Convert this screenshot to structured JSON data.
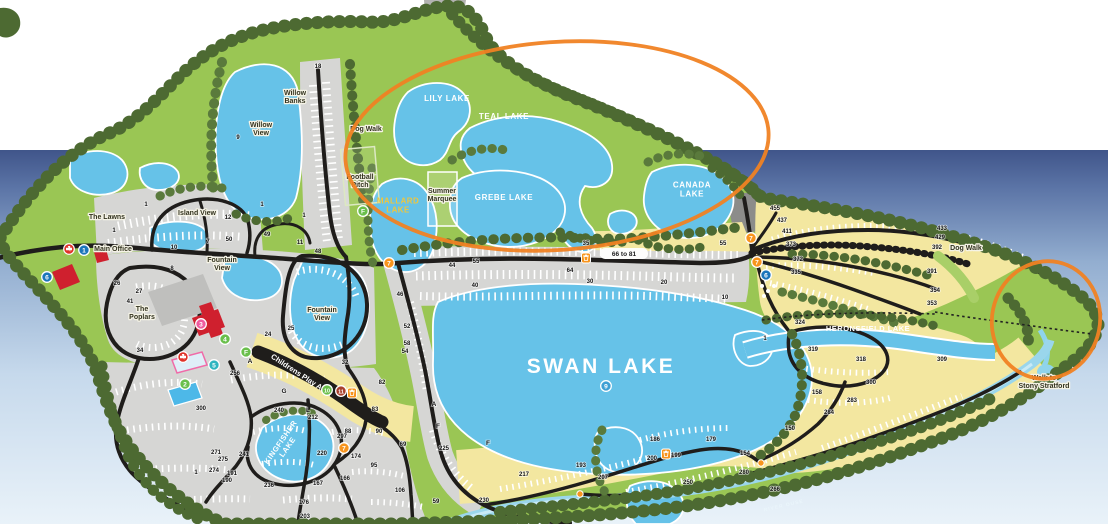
{
  "annotations": {
    "color": "#f08223",
    "ellipses": [
      {
        "cx": 557,
        "cy": 146,
        "rx": 212,
        "ry": 104,
        "rotate": -4
      },
      {
        "cx": 1046,
        "cy": 320,
        "rx": 54,
        "ry": 59,
        "rotate": 12
      }
    ]
  },
  "map": {
    "labels": [
      {
        "text": "LILY LAKE",
        "x": 447,
        "y": 101,
        "kind": "lake"
      },
      {
        "text": "TEAL LAKE",
        "x": 504,
        "y": 119,
        "kind": "lake"
      },
      {
        "text": "GREBE LAKE",
        "x": 504,
        "y": 200,
        "kind": "lake"
      },
      {
        "text": "CANADA\nLAKE",
        "x": 692,
        "y": 192,
        "kind": "lake"
      },
      {
        "text": "MALLARD\nLAKE",
        "x": 398,
        "y": 208,
        "kind": "lake_yellow"
      },
      {
        "text": "SWAN LAKE",
        "x": 601,
        "y": 373,
        "kind": "lake_big"
      },
      {
        "text": "HERONSFIELD LAKE",
        "x": 868,
        "y": 331,
        "kind": "lake_small"
      },
      {
        "text": "KINGFISHER\nLAKE",
        "x": 286,
        "y": 446,
        "kind": "lake_small",
        "rotate": -55
      },
      {
        "text": "Willow\nBanks",
        "x": 295,
        "y": 99,
        "kind": "place"
      },
      {
        "text": "Willow\nView",
        "x": 261,
        "y": 131,
        "kind": "place"
      },
      {
        "text": "Island View",
        "x": 197,
        "y": 215,
        "kind": "place"
      },
      {
        "text": "The Lawns",
        "x": 107,
        "y": 219,
        "kind": "place"
      },
      {
        "text": "Main Office",
        "x": 113,
        "y": 251,
        "kind": "place"
      },
      {
        "text": "Fountain\nView",
        "x": 222,
        "y": 266,
        "kind": "place"
      },
      {
        "text": "Fountain\nView",
        "x": 322,
        "y": 316,
        "kind": "place"
      },
      {
        "text": "The\nPoplars",
        "x": 142,
        "y": 315,
        "kind": "place"
      },
      {
        "text": "Dog Walk",
        "x": 366,
        "y": 131,
        "kind": "place"
      },
      {
        "text": "Dog Walk",
        "x": 966,
        "y": 250,
        "kind": "place"
      },
      {
        "text": "Football\nPitch",
        "x": 360,
        "y": 183,
        "kind": "place"
      },
      {
        "text": "Summer\nMarquee",
        "x": 442,
        "y": 197,
        "kind": "place"
      },
      {
        "text": "Childrens Play Area",
        "x": 300,
        "y": 377,
        "kind": "play",
        "rotate": 33
      },
      {
        "text": "Walk to\nStony Stratford",
        "x": 1044,
        "y": 384,
        "kind": "place"
      },
      {
        "text": "66 to 81",
        "x": 624,
        "y": 256,
        "kind": "road"
      },
      {
        "text": "RIVER OUSE",
        "x": 784,
        "y": 507,
        "kind": "river",
        "rotate": -13
      }
    ],
    "site_numbers": [
      [
        "18",
        318,
        68
      ],
      [
        "9",
        238,
        139
      ],
      [
        "1",
        146,
        206
      ],
      [
        "1",
        262,
        206
      ],
      [
        "12",
        228,
        219
      ],
      [
        "1",
        304,
        217
      ],
      [
        "1",
        114,
        232
      ],
      [
        "49",
        267,
        236
      ],
      [
        "50",
        229,
        241
      ],
      [
        "7",
        208,
        243
      ],
      [
        "10",
        174,
        249
      ],
      [
        "8",
        172,
        270
      ],
      [
        "11",
        300,
        244
      ],
      [
        "48",
        318,
        253
      ],
      [
        "26",
        117,
        285
      ],
      [
        "27",
        139,
        293
      ],
      [
        "41",
        130,
        303
      ],
      [
        "25",
        291,
        330
      ],
      [
        "24",
        268,
        336
      ],
      [
        "34",
        140,
        352
      ],
      [
        "32",
        345,
        364
      ],
      [
        "256",
        235,
        375
      ],
      [
        "300",
        201,
        410
      ],
      [
        "240",
        279,
        412
      ],
      [
        "212",
        313,
        419
      ],
      [
        "82",
        382,
        384
      ],
      [
        "83",
        375,
        411
      ],
      [
        "88",
        348,
        433
      ],
      [
        "297",
        342,
        438
      ],
      [
        "90",
        379,
        433
      ],
      [
        "69",
        403,
        446
      ],
      [
        "220",
        322,
        455
      ],
      [
        "174",
        356,
        458
      ],
      [
        "95",
        374,
        467
      ],
      [
        "241",
        244,
        456
      ],
      [
        "271",
        216,
        454
      ],
      [
        "275",
        223,
        461
      ],
      [
        "274",
        214,
        472
      ],
      [
        "191",
        232,
        475
      ],
      [
        "190",
        227,
        482
      ],
      [
        "1",
        196,
        474
      ],
      [
        "236",
        269,
        487
      ],
      [
        "167",
        318,
        485
      ],
      [
        "166",
        345,
        480
      ],
      [
        "176",
        304,
        504
      ],
      [
        "203",
        305,
        518
      ],
      [
        "106",
        400,
        492
      ],
      [
        "59",
        436,
        503
      ],
      [
        "225",
        444,
        450
      ],
      [
        "230",
        484,
        502
      ],
      [
        "217",
        524,
        476
      ],
      [
        "193",
        581,
        467
      ],
      [
        "207",
        603,
        479
      ],
      [
        "186",
        655,
        441
      ],
      [
        "179",
        711,
        441
      ],
      [
        "200",
        652,
        460
      ],
      [
        "199",
        676,
        457
      ],
      [
        "154",
        745,
        455
      ],
      [
        "280",
        744,
        474
      ],
      [
        "250",
        688,
        484
      ],
      [
        "266",
        775,
        491
      ],
      [
        "150",
        790,
        430
      ],
      [
        "158",
        817,
        394
      ],
      [
        "284",
        829,
        414
      ],
      [
        "283",
        852,
        402
      ],
      [
        "300",
        871,
        384
      ],
      [
        "318",
        861,
        361
      ],
      [
        "319",
        813,
        351
      ],
      [
        "324",
        800,
        324
      ],
      [
        "309",
        942,
        361
      ],
      [
        "353",
        932,
        305
      ],
      [
        "354",
        935,
        292
      ],
      [
        "391",
        932,
        273
      ],
      [
        "392",
        937,
        249
      ],
      [
        "429",
        940,
        239
      ],
      [
        "433",
        942,
        230
      ],
      [
        "335",
        796,
        274
      ],
      [
        "372",
        798,
        261
      ],
      [
        "373",
        791,
        246
      ],
      [
        "411",
        787,
        233
      ],
      [
        "437",
        782,
        222
      ],
      [
        "455",
        775,
        210
      ],
      [
        "35",
        586,
        245
      ],
      [
        "55",
        723,
        245
      ],
      [
        "44",
        452,
        267
      ],
      [
        "55",
        476,
        263
      ],
      [
        "64",
        570,
        272
      ],
      [
        "40",
        475,
        287
      ],
      [
        "30",
        590,
        283
      ],
      [
        "20",
        664,
        284
      ],
      [
        "10",
        725,
        299
      ],
      [
        "1",
        765,
        340
      ],
      [
        "46",
        400,
        296
      ],
      [
        "52",
        407,
        328
      ],
      [
        "58",
        407,
        345
      ],
      [
        "54",
        405,
        353
      ]
    ],
    "letters": [
      [
        "A",
        250,
        363
      ],
      [
        "G",
        284,
        393
      ],
      [
        "L",
        308,
        412
      ],
      [
        "A",
        434,
        406
      ],
      [
        "F",
        438,
        428
      ],
      [
        "F",
        488,
        445
      ]
    ],
    "markers": [
      {
        "kind": "cross",
        "x": 69,
        "y": 249
      },
      {
        "kind": "circle",
        "label": "1",
        "color": "#1b75bb",
        "x": 84,
        "y": 250
      },
      {
        "kind": "circle",
        "label": "6",
        "color": "#1b75bb",
        "x": 47,
        "y": 277
      },
      {
        "kind": "circle",
        "label": "3",
        "color": "#ef5b9f",
        "x": 201,
        "y": 324
      },
      {
        "kind": "circle",
        "label": "4",
        "color": "#6abf4b",
        "x": 225,
        "y": 339
      },
      {
        "kind": "circle",
        "label": "F",
        "color": "#6abf4b",
        "x": 246,
        "y": 352
      },
      {
        "kind": "circle",
        "label": "5",
        "color": "#2eb5c0",
        "x": 214,
        "y": 365
      },
      {
        "kind": "cross",
        "x": 183,
        "y": 357
      },
      {
        "kind": "circle",
        "label": "2",
        "color": "#6abf4b",
        "x": 185,
        "y": 384
      },
      {
        "kind": "circle",
        "label": "10",
        "color": "#6abf4b",
        "x": 327,
        "y": 390
      },
      {
        "kind": "circle",
        "label": "11",
        "color": "#a8402c",
        "x": 341,
        "y": 391
      },
      {
        "kind": "bin",
        "label": "7",
        "color": "#f7941d",
        "x": 352,
        "y": 393
      },
      {
        "kind": "circle",
        "label": "7",
        "color": "#f7941d",
        "x": 344,
        "y": 448
      },
      {
        "kind": "circle",
        "label": "F",
        "color": "#6abf4b",
        "x": 363,
        "y": 211
      },
      {
        "kind": "circle",
        "label": "7",
        "color": "#f7941d",
        "x": 389,
        "y": 263
      },
      {
        "kind": "bin",
        "label": "7",
        "color": "#f7941d",
        "x": 586,
        "y": 258
      },
      {
        "kind": "circle",
        "label": "7",
        "color": "#f7941d",
        "x": 751,
        "y": 238
      },
      {
        "kind": "circle",
        "label": "7",
        "color": "#f7941d",
        "x": 757,
        "y": 262
      },
      {
        "kind": "circle",
        "label": "6",
        "color": "#1b75bb",
        "x": 766,
        "y": 275
      },
      {
        "kind": "circle",
        "label": "9",
        "color": "#3e9fd4",
        "x": 606,
        "y": 386
      },
      {
        "kind": "bin",
        "label": "7",
        "color": "#f7941d",
        "x": 666,
        "y": 454
      },
      {
        "kind": "dot",
        "color": "#f7941d",
        "x": 580,
        "y": 494
      },
      {
        "kind": "dot",
        "color": "#f7941d",
        "x": 761,
        "y": 463
      }
    ]
  }
}
